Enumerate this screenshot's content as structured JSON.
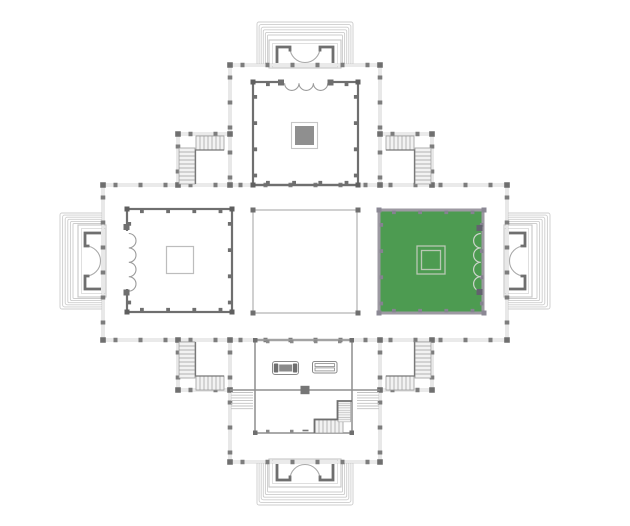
{
  "diagram": {
    "type": "architectural-floor-plan",
    "subject": "cruciform plan: four porticoed entrances with stepped platforms, four corner stair rooms, nine-square interior, one room highlighted",
    "highlighted_room": "east-room"
  },
  "colors": {
    "background": "#ffffff",
    "wall_light": "#c6c6c6",
    "wall_dark": "#6f6f6f",
    "pilaster": "#7d7d7d",
    "highlight_fill": "#4d9b51",
    "highlight_border": "#9d99a2",
    "ornament_fill": "#8f8f8f",
    "stair_line": "#9c9c9c"
  },
  "rooms": [
    {
      "id": "north-room",
      "highlighted": false
    },
    {
      "id": "west-room",
      "highlighted": false
    },
    {
      "id": "central-hall",
      "highlighted": false
    },
    {
      "id": "east-room",
      "highlighted": true
    },
    {
      "id": "south-room",
      "highlighted": false
    }
  ]
}
